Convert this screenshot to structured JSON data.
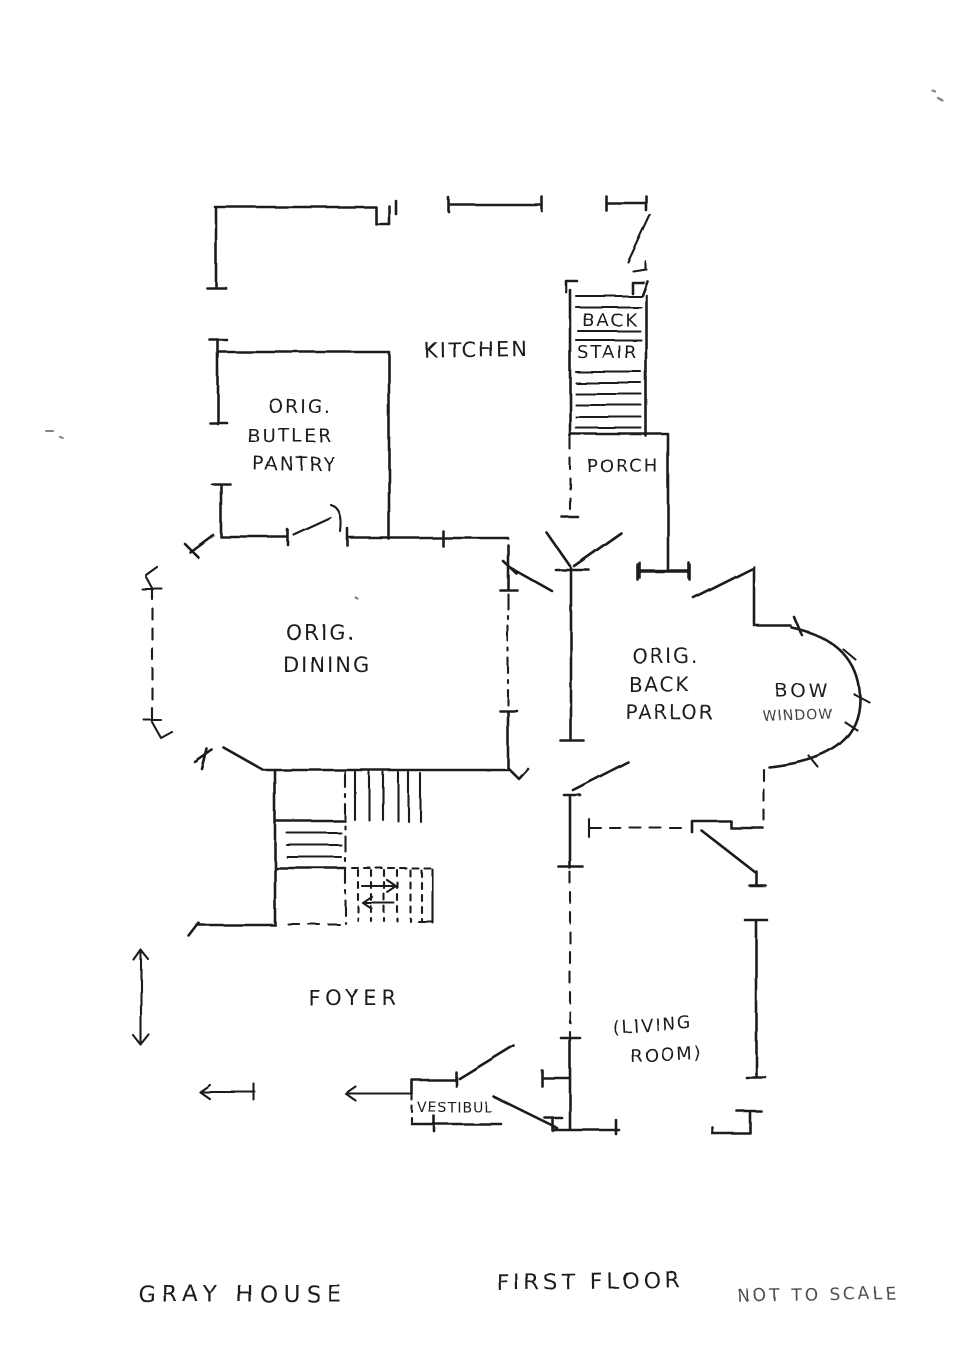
{
  "page": {
    "background": "#ffffff",
    "ink": "#1f1f1f"
  },
  "titles": {
    "house": "GRAY HOUSE",
    "floor": "FIRST FLOOR",
    "scale_note": "NOT TO SCALE"
  },
  "rooms": {
    "kitchen": {
      "label": "KITCHEN"
    },
    "back_stair": {
      "line1": "BACK",
      "line2": "STAIR"
    },
    "porch": {
      "label": "PORCH"
    },
    "butler_pantry": {
      "line1": "ORIG.",
      "line2": "BUTLER",
      "line3": "PANTRY"
    },
    "dining": {
      "line1": "ORIG.",
      "line2": "DINING"
    },
    "back_parlor": {
      "line1": "ORIG.",
      "line2": "BACK",
      "line3": "PARLOR"
    },
    "bow_window": {
      "line1": "BOW",
      "line2": "WINDOW"
    },
    "foyer": {
      "label": "FOYER"
    },
    "living_room": {
      "line1": "(LIVING",
      "line2": "ROOM)"
    },
    "vestibule": {
      "label": "VESTIBUL"
    }
  }
}
